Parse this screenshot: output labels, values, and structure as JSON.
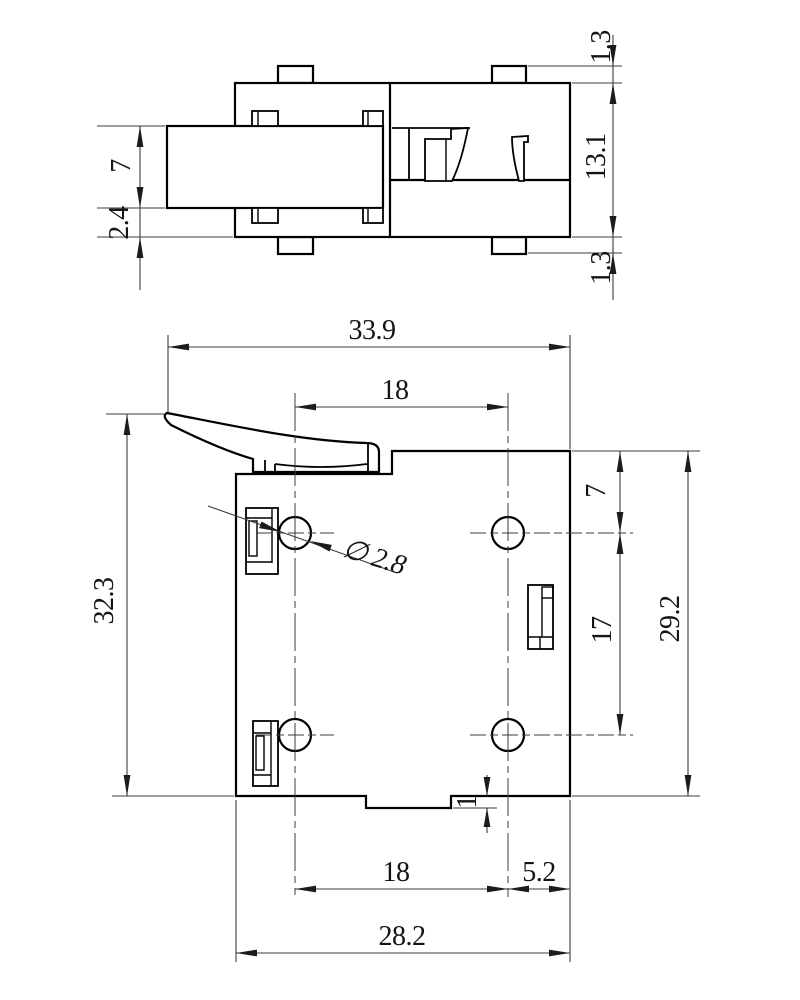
{
  "colors": {
    "background": "#ffffff",
    "line": "#000000",
    "dimension": "#3c3c3c"
  },
  "side_view": {
    "label": "side-profile-view",
    "dims": {
      "tab_top": "1.3",
      "body_height": "13.1",
      "tab_bottom": "1.3",
      "slider_height": "7",
      "slider_offset": "2.4"
    }
  },
  "plan_view": {
    "label": "bottom-plan-view",
    "dims": {
      "overall_width": "33.9",
      "hole_pitch_top": "18",
      "overall_height": "32.3",
      "hole_top_offset": "7",
      "hole_pitch_vertical": "17",
      "body_height": "29.2",
      "hole_diameter": "∅ 2.8",
      "hole_pitch_bottom": "18",
      "hole_edge_offset": "5.2",
      "body_width": "28.2",
      "boss_height": "1"
    }
  }
}
